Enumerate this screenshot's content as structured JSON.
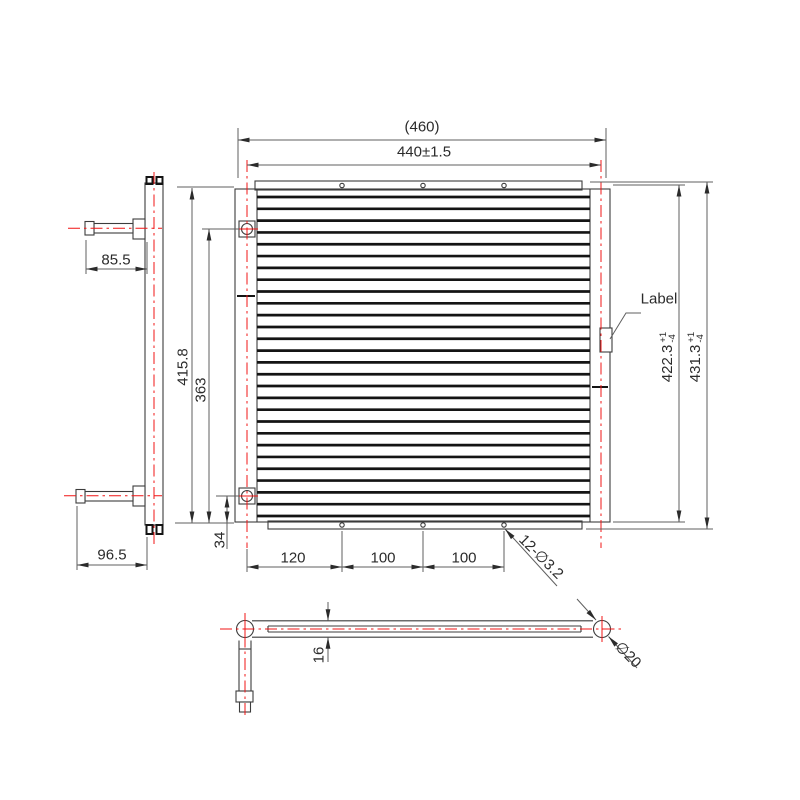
{
  "colors": {
    "centerline_red": "#f01414",
    "outline_gray": "#3c3c3c",
    "dimension_gray": "#5f5f5f"
  },
  "views": {
    "front_view": {
      "tube_count": 28
    }
  },
  "dimensions": {
    "overall_width_ref": "(460)",
    "core_width": "440±1.5",
    "top_pipe_length": "85.5",
    "bottom_pipe_length": "96.5",
    "side_height": "415.8",
    "port_span": "363",
    "port_bottom_offset": "34",
    "core_height": {
      "value": "422.3",
      "tol_plus": "+1",
      "tol_minus": "-4"
    },
    "overall_height": {
      "value": "431.3",
      "tol_plus": "+1",
      "tol_minus": "-4"
    },
    "hole_spacing_1": "120",
    "hole_spacing_2": "100",
    "hole_spacing_3": "100",
    "mounting_holes": "12-∅3.2",
    "coil_thickness": "16",
    "header_diameter": "∅20"
  },
  "annotations": {
    "label_callout": "Label"
  }
}
